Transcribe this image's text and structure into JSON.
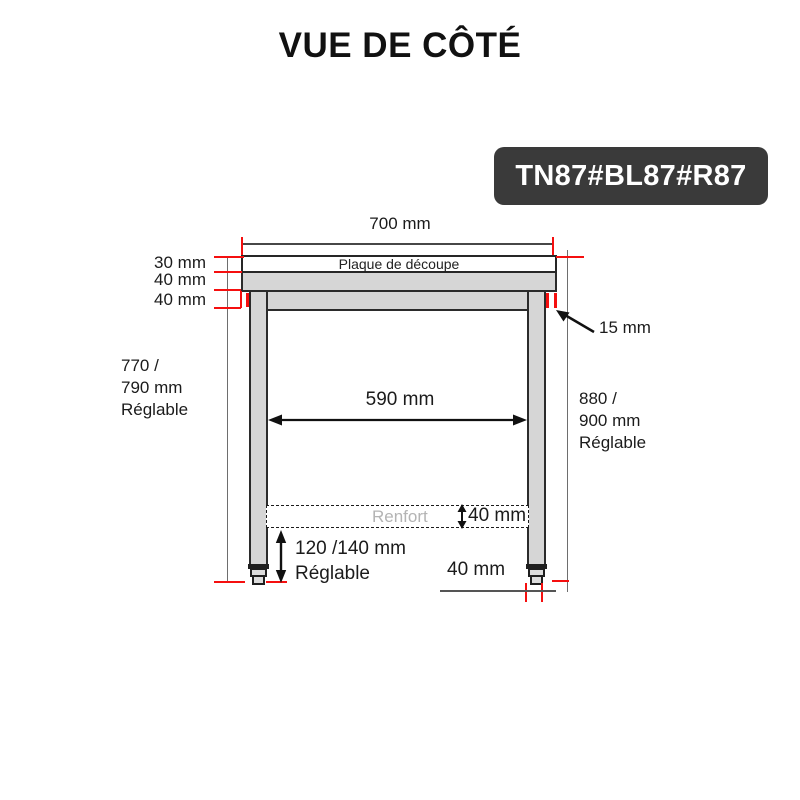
{
  "title": "VUE DE CÔTÉ",
  "badge": {
    "label": "TN87#BL87#R87",
    "bg": "#3a3a3a"
  },
  "colors": {
    "dimension_red": "#f50f0f",
    "steel_gray": "#d6d6d6",
    "outline_dark": "#2b2b2b",
    "extension_gray": "#6e6e6e",
    "renfort_text_gray": "#b4b4b4",
    "badge_bg": "#3a3a3a"
  },
  "dimensions": {
    "top_width": "700 mm",
    "plaque_label": "Plaque de découpe",
    "thickness_top": "30 mm",
    "thickness_mid": "40 mm",
    "thickness_low": "40 mm",
    "height_left": "770 /\n790 mm\nRéglable",
    "height_right": "880 /\n900 mm\nRéglable",
    "leg_thickness": "15 mm",
    "inner_width": "590 mm",
    "renfort_label": "Renfort",
    "renfort_height": "40 mm",
    "foot_adjust": "120 /140 mm\nRéglable",
    "foot_width": "40 mm"
  }
}
